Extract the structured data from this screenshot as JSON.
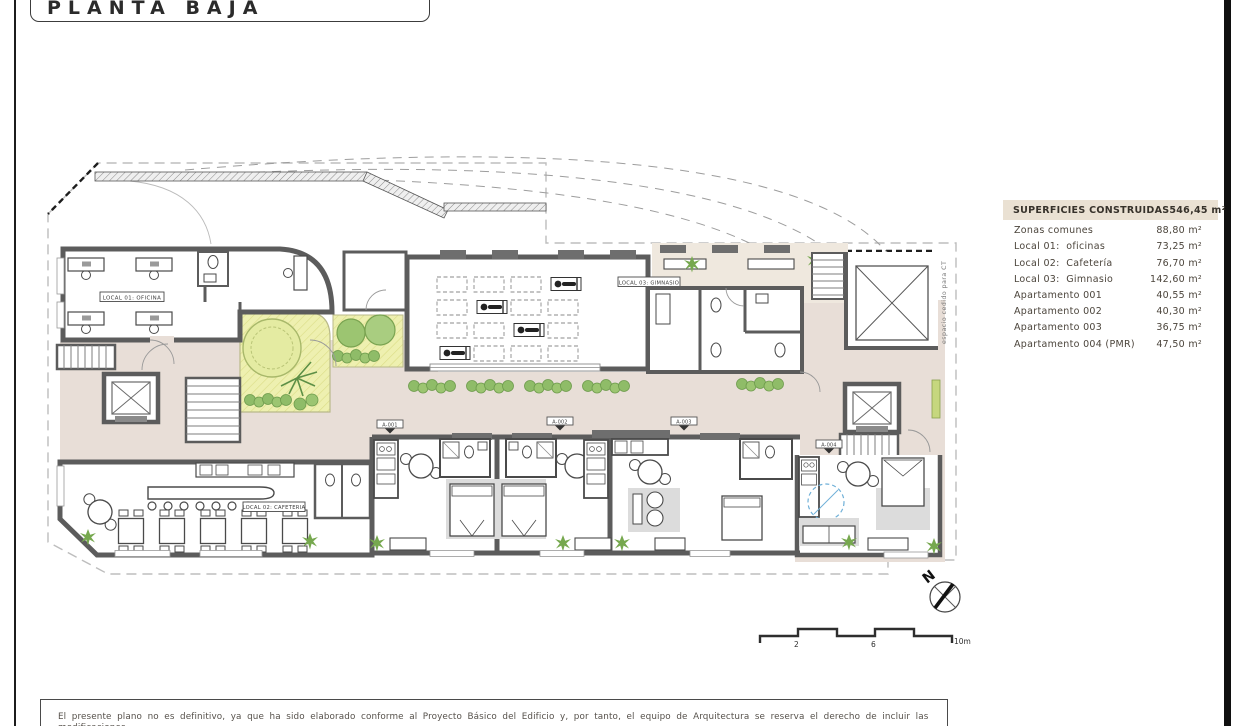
{
  "title": "PLANTA BAJA",
  "legend": {
    "header": {
      "label": "SUPERFICIES CONSTRUIDAS",
      "value": "546,45 m²"
    },
    "rows": [
      {
        "label": "Zonas comunes",
        "value": "88,80 m²"
      },
      {
        "label": "Local 01:  oficinas",
        "value": "73,25 m²"
      },
      {
        "label": "Local 02:  Cafetería",
        "value": "76,70 m²"
      },
      {
        "label": "Local 03:  Gimnasio",
        "value": "142,60 m²"
      },
      {
        "label": "Apartamento 001",
        "value": "40,55 m²"
      },
      {
        "label": "Apartamento 002",
        "value": "40,30 m²"
      },
      {
        "label": "Apartamento 003",
        "value": "36,75 m²"
      },
      {
        "label": "Apartamento 004 (PMR)",
        "value": "47,50 m²"
      }
    ]
  },
  "plan": {
    "room_labels": {
      "office": "LOCAL 01: OFICINA",
      "cafeteria": "LOCAL 02: CAFETERIA",
      "gym": "LOCAL 03: GIMNASIO",
      "ct": "espacio cedido para CT"
    },
    "door_tags": [
      "A-001",
      "A-002",
      "A-003",
      "A-004"
    ],
    "north_label": "N",
    "scale_labels": [
      "2",
      "6",
      "10m"
    ]
  },
  "disclaimer": "El presente plano no es definitivo, ya que ha sido elaborado conforme al Proyecto Básico del Edificio y, por tanto, el equipo de Arquitectura se reserva el derecho de incluir las modificaciones",
  "colors": {
    "wall": "#5c5c5c",
    "common_floor": "#e8ded7",
    "terrace_floor": "#efe8de",
    "garden": "#eef0b0",
    "tree": "#9cc571",
    "shrub": "#8fbc68",
    "accessibility_blue": "#6fb0d8",
    "legend_header_bg": "#eae1d3"
  }
}
